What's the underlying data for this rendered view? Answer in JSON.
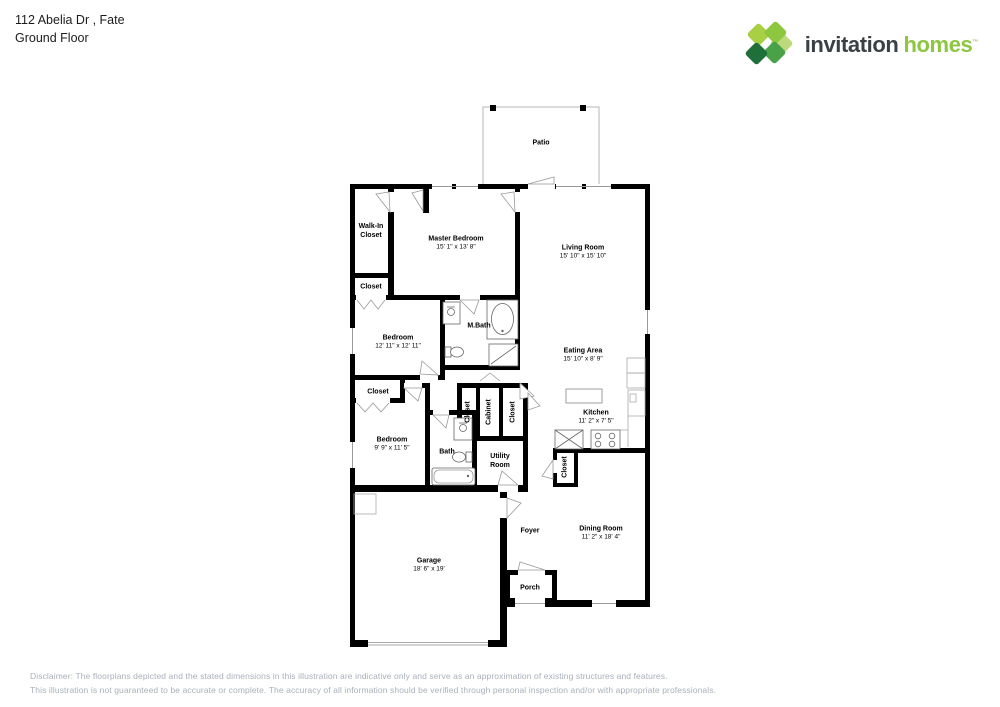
{
  "header": {
    "address": "112 Abelia Dr , Fate",
    "floor": "Ground Floor"
  },
  "logo": {
    "brand_primary": "invitation",
    "brand_secondary": "homes",
    "trademark": "™",
    "brand_green": "#8dc63f",
    "brand_dark": "#3b4045"
  },
  "plan": {
    "wall_color": "#000000",
    "rooms": {
      "patio": {
        "name": "Patio"
      },
      "walk_in_closet": {
        "name": "Walk-In Closet"
      },
      "master_bedroom": {
        "name": "Master Bedroom",
        "dims": "15' 1\" x 13' 8\""
      },
      "living_room": {
        "name": "Living Room",
        "dims": "15' 10\" x 15' 10\""
      },
      "closet_a": {
        "name": "Closet"
      },
      "bedroom_1": {
        "name": "Bedroom",
        "dims": "12' 11\" x 12' 11\""
      },
      "m_bath": {
        "name": "M.Bath"
      },
      "eating_area": {
        "name": "Eating Area",
        "dims": "15' 10\" x 8' 9\""
      },
      "closet_b": {
        "name": "Closet"
      },
      "closet_c": {
        "name": "Closet"
      },
      "cabinet": {
        "name": "Cabinet"
      },
      "closet_d": {
        "name": "Closet"
      },
      "kitchen": {
        "name": "Kitchen",
        "dims": "11' 2\" x 7' 5\""
      },
      "bedroom_2": {
        "name": "Bedroom",
        "dims": "9' 9\" x 11' 5\""
      },
      "bath": {
        "name": "Bath"
      },
      "utility_room": {
        "name": "Utility Room"
      },
      "closet_e": {
        "name": "Closet"
      },
      "foyer": {
        "name": "Foyer"
      },
      "dining_room": {
        "name": "Dining Room",
        "dims": "11' 2\" x 18' 4\""
      },
      "garage": {
        "name": "Garage",
        "dims": "18' 6\" x 19'"
      },
      "porch": {
        "name": "Porch"
      }
    },
    "fixtures": [
      "bathtub",
      "shower",
      "toilet",
      "sink-vanity",
      "kitchen-island",
      "kitchen-sink",
      "stove",
      "refrigerator",
      "counter-cabinets",
      "water-heater-pad"
    ]
  },
  "disclaimer": {
    "line1": "Disclaimer: The floorplans depicted and the stated dimensions in this illustration are indicative only and serve as an approximation of existing structures and features.",
    "line2": "This illustration is not guaranteed to be accurate or complete. The accuracy of all information should be verified through personal inspection and/or with appropriate professionals."
  }
}
